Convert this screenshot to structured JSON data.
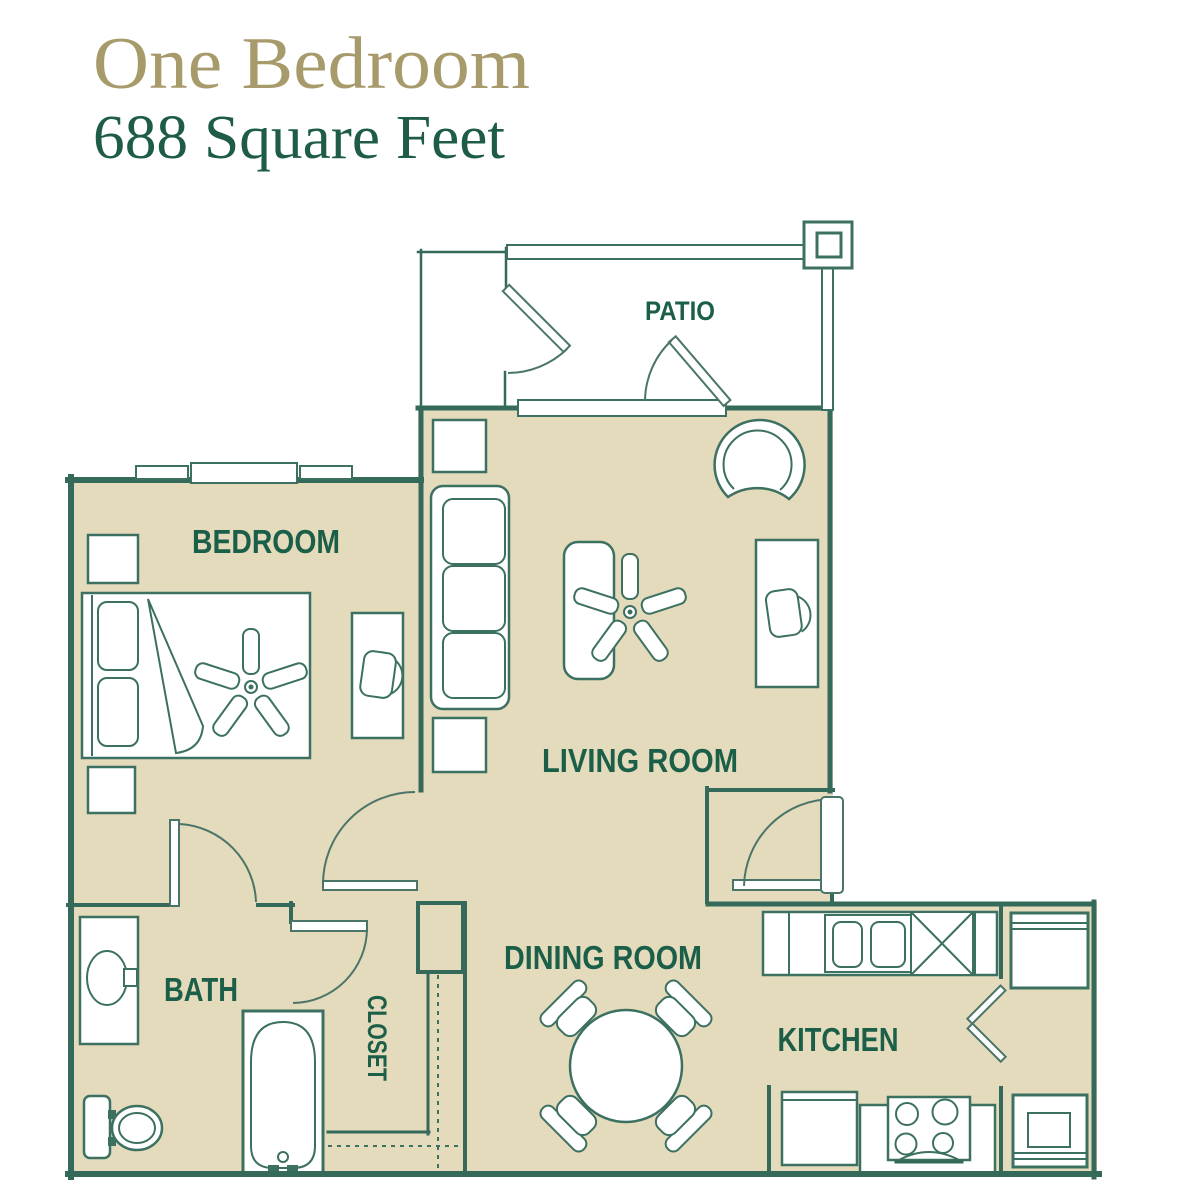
{
  "header": {
    "title": "One Bedroom",
    "subtitle": "688 Square Feet",
    "title_color": "#A79B6B",
    "subtitle_color": "#1E5C49"
  },
  "floor_plan": {
    "wall_color": "#35695A",
    "floor_color": "#E4DABC",
    "furniture_outline_color": "#3C7060",
    "label_color": "#1B5F49",
    "rooms": [
      {
        "id": "patio",
        "label": "PATIO"
      },
      {
        "id": "bedroom",
        "label": "BEDROOM"
      },
      {
        "id": "living-room",
        "label": "LIVING ROOM"
      },
      {
        "id": "bath",
        "label": "BATH"
      },
      {
        "id": "closet",
        "label": "CLOSET"
      },
      {
        "id": "dining-room",
        "label": "DINING ROOM"
      },
      {
        "id": "kitchen",
        "label": "KITCHEN"
      }
    ],
    "furniture": [
      "bed",
      "pillow",
      "blanket-fold",
      "ceiling-fan",
      "nightstand",
      "desk",
      "desk-chair",
      "sofa",
      "end-table",
      "coffee-table",
      "corner-chair",
      "dining-table",
      "dining-chair",
      "vanity-sink",
      "toilet",
      "bathtub",
      "kitchen-counter",
      "kitchen-sink",
      "dishwasher",
      "refrigerator",
      "range-stove",
      "washer",
      "bifold-door",
      "entry-door",
      "interior-door",
      "window",
      "patio-railing",
      "patio-post",
      "closet-shelf-dashed"
    ]
  }
}
